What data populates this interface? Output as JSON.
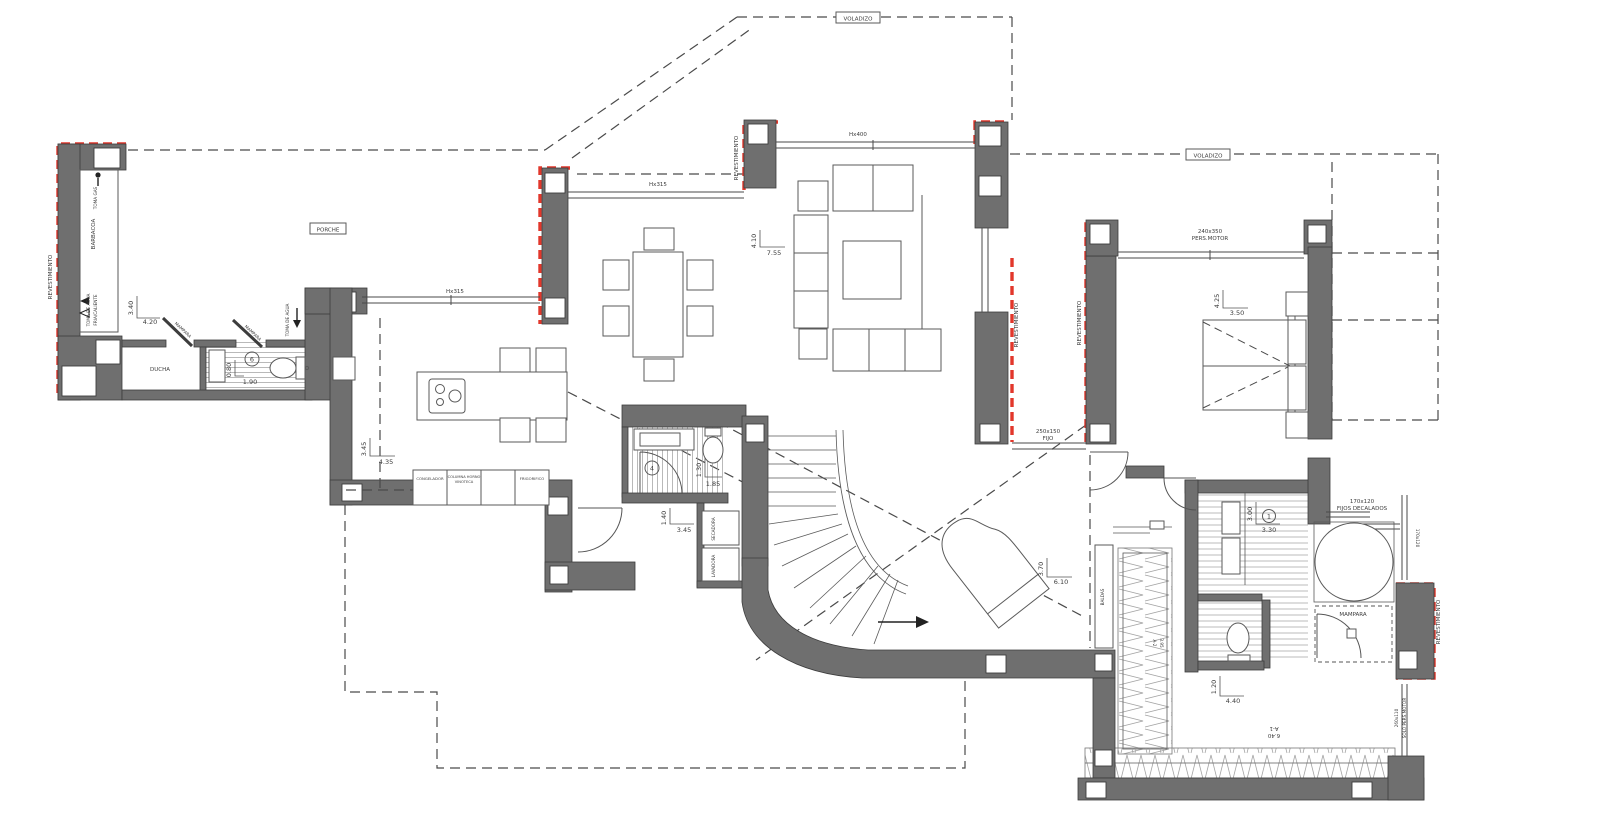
{
  "plan": {
    "colors": {
      "wall": "#6f6f6f",
      "cladding_red": "#e2372b"
    },
    "labels": {
      "voladizo": "VOLADIZO",
      "porche": "PORCHE",
      "revestimiento": "REVESTIMIENTO",
      "barbacoa": "BARBACOA",
      "toma_gas": "TOMA GAS",
      "toma_agua": "TOMA DE AGUA",
      "fria_caliente": "FRIA/CALIENTE",
      "ducha": "DUCHA",
      "mampara": "MAMPARA",
      "baldas": "BALDAS",
      "secadora": "SECADORA",
      "lavadora": "LAVADORA",
      "congelador": "CONGELADOR",
      "columna_horno": "COLUMNA HORNO",
      "vinoteca": "VINOTECA",
      "frigorifico": "FRIGORIFICO"
    },
    "windows": {
      "hx315": "Hx315",
      "hx400": "Hx400",
      "pers_motor_size": "240x350",
      "pers_motor": "PERS.MOTOR",
      "fijo_size": "250x150",
      "fijo": "FIJO",
      "fijos_size": "170x120",
      "fijos_decalados": "FIJOS DECALADOS",
      "lateral_size": "170x120",
      "solo_size": "260x110",
      "solo_pers": "SOLO PERS.MOTOR"
    },
    "dims": {
      "porche_v": "3.40",
      "porche_h": "4.20",
      "bath1_v": "0.80",
      "bath1_h": "1.90",
      "kitchen_v": "3.45",
      "kitchen_h": "4.35",
      "living_v": "4.10",
      "living_h": "7.55",
      "bedroom_v": "4.25",
      "bedroom_h": "3.50",
      "bath2_v": "1.30",
      "bath2_h": "1.85",
      "hall_v": "1.40",
      "hall_h": "3.45",
      "piano_v": "3.70",
      "piano_h": "6.10",
      "vanity_v": "3.00",
      "vanity_h": "3.30",
      "terrace_v": "1.20",
      "terrace_h": "4.40"
    },
    "refs": {
      "bath1": "6",
      "bath2": "4",
      "vanity": "1",
      "a1_code": "A-1",
      "a1_len": "6.40",
      "a2_code": "A-2",
      "a2_len": "3.95"
    }
  }
}
